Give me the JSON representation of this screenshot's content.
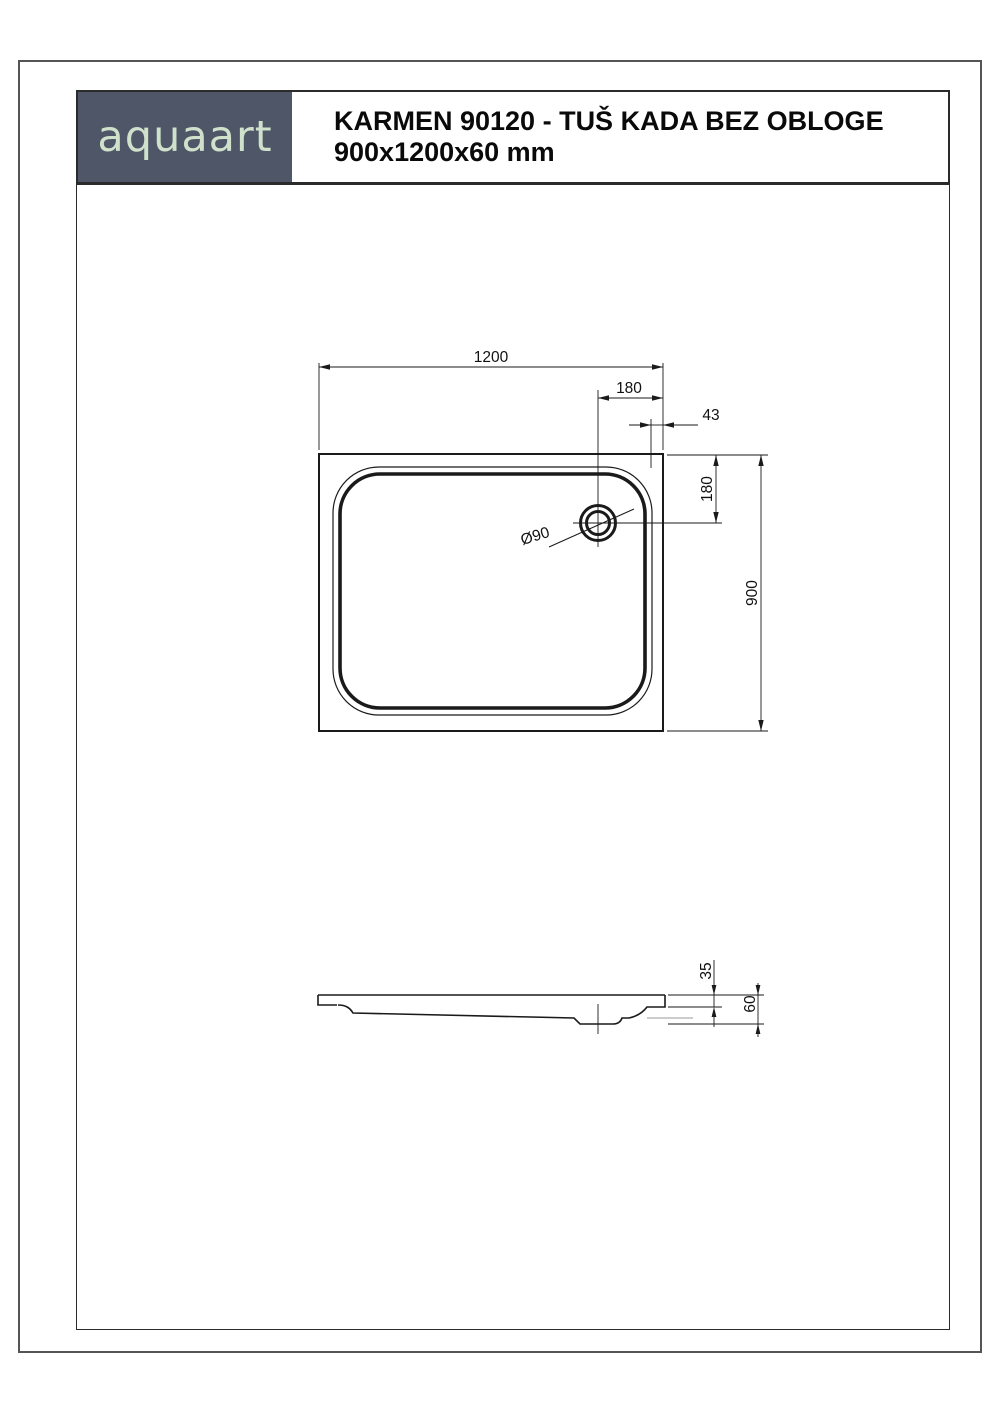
{
  "header": {
    "logo": "aquaart",
    "title_line1": "KARMEN 90120 - TUŠ KADA BEZ OBLOGE",
    "title_line2": "900x1200x60 mm"
  },
  "colors": {
    "logo_bg": "#4f5668",
    "logo_text": "#cfe0cb"
  },
  "drawing": {
    "top_view": {
      "dim_width": "1200",
      "dim_drain_to_right_edge": "180",
      "dim_rim_width": "43",
      "dim_drain_to_top_edge": "180",
      "dim_depth": "900",
      "drain_diameter": "Ø90"
    },
    "side_view": {
      "dim_basin_depth": "35",
      "dim_total_height": "60"
    }
  }
}
